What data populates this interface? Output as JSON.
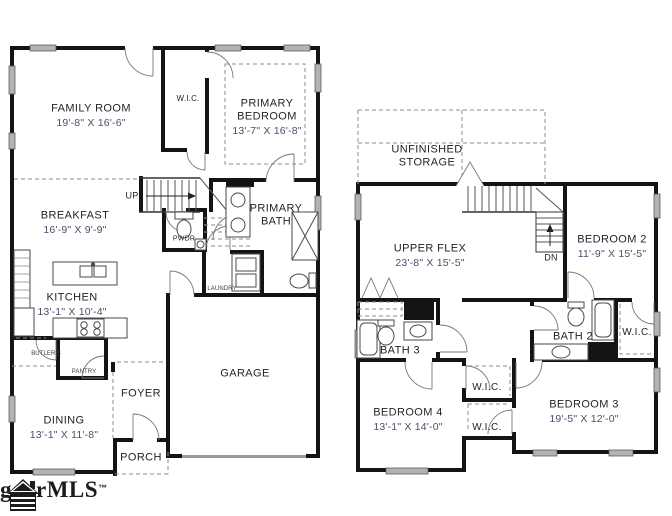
{
  "colors": {
    "wall": "#141414",
    "window": "#b3b3b3",
    "dashed": "#8e8e8e",
    "room_text": "#23232b",
    "dims_text": "#4a5068"
  },
  "logo": {
    "text": "ggarMLS",
    "trademark": "™",
    "icon": "house-icon"
  },
  "floor1": {
    "family_room": {
      "label": "FAMILY ROOM",
      "dims": "19'-8\" X 16'-6\""
    },
    "wic": {
      "label": "W.I.C."
    },
    "primary_bedroom": {
      "label": "PRIMARY",
      "label2": "BEDROOM",
      "dims": "13'-7\" X 16'-8\""
    },
    "breakfast": {
      "label": "BREAKFAST",
      "dims": "16'-9\" X 9'-9\""
    },
    "up": {
      "label": "UP"
    },
    "pwdr": {
      "label": "PWDR"
    },
    "primary_bath": {
      "label": "PRIMARY",
      "label2": "BATH"
    },
    "laundry": {
      "label": "LAUNDRY"
    },
    "kitchen": {
      "label": "KITCHEN",
      "dims": "13'-1\" X 10'-4\""
    },
    "butlers": {
      "label": "BUTLER'S"
    },
    "pantry": {
      "label": "PANTRY"
    },
    "foyer": {
      "label": "FOYER"
    },
    "dining": {
      "label": "DINING",
      "dims": "13'-1\" X 11'-8\""
    },
    "porch": {
      "label": "PORCH"
    },
    "garage": {
      "label": "GARAGE"
    }
  },
  "floor2": {
    "unfinished_storage": {
      "label": "UNFINISHED",
      "label2": "STORAGE"
    },
    "upper_flex": {
      "label": "UPPER FLEX",
      "dims": "23'-8\" X 15'-5\""
    },
    "dn": {
      "label": "DN"
    },
    "bedroom2": {
      "label": "BEDROOM 2",
      "dims": "11'-9\" X 15'-5\""
    },
    "bath3": {
      "label": "BATH 3"
    },
    "bath2": {
      "label": "BATH 2"
    },
    "wic_right": {
      "label": "W.I.C."
    },
    "wic_mid_upper": {
      "label": "W.I.C."
    },
    "wic_mid_lower": {
      "label": "W.I.C."
    },
    "bedroom4": {
      "label": "BEDROOM 4",
      "dims": "13'-1\" X 14'-0\""
    },
    "bedroom3": {
      "label": "BEDROOM 3",
      "dims": "19'-5\" X 12'-0\""
    }
  }
}
